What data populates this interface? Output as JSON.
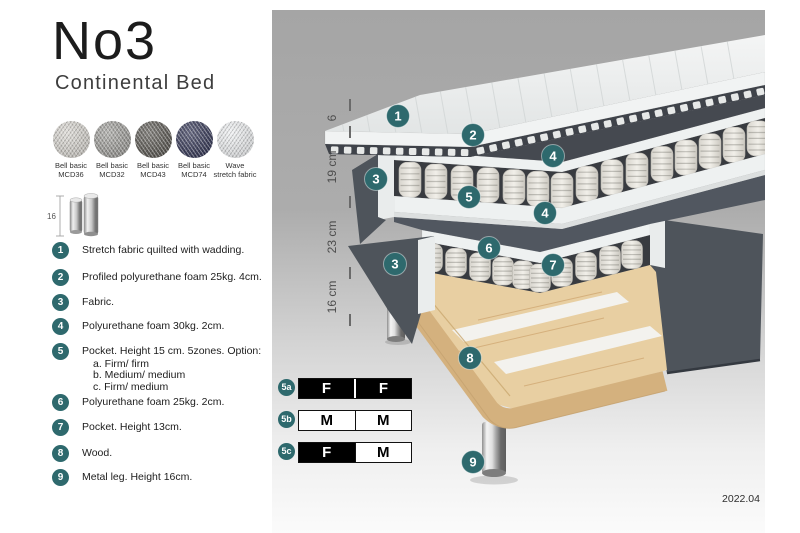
{
  "product": {
    "title": "No3",
    "subtitle": "Continental Bed",
    "version": "2022.04"
  },
  "colors": {
    "accent_teal": "#2e696d",
    "fabric_dark": "#4e545b",
    "wood": "#e8cfa2"
  },
  "swatches": [
    {
      "name": "Bell basic",
      "code": "MCD36",
      "color": "#d6d3cd"
    },
    {
      "name": "Bell basic",
      "code": "MCD32",
      "color": "#9c9b97"
    },
    {
      "name": "Bell basic",
      "code": "MCD43",
      "color": "#57544e"
    },
    {
      "name": "Bell basic",
      "code": "MCD74",
      "color": "#2f3253"
    },
    {
      "name": "Wave",
      "code": "stretch fabric",
      "color": "#edeff1"
    }
  ],
  "leg_spec": {
    "height_label": "16"
  },
  "legend": [
    {
      "num": "1",
      "text": "Stretch fabric quilted with wadding."
    },
    {
      "num": "2",
      "text": "Profiled polyurethane foam 25kg. 4cm."
    },
    {
      "num": "3",
      "text": "Fabric."
    },
    {
      "num": "4",
      "text": "Polyurethane foam 30kg. 2cm."
    },
    {
      "num": "5",
      "text": "Pocket. Height 15 cm. 5zones. Option:",
      "options": [
        "a. Firm/ firm",
        "b. Medium/ medium",
        "c. Firm/ medium"
      ]
    },
    {
      "num": "6",
      "text": "Polyurethane foam 25kg. 2cm."
    },
    {
      "num": "7",
      "text": "Pocket. Height 13cm."
    },
    {
      "num": "8",
      "text": "Wood."
    },
    {
      "num": "9",
      "text": "Metal leg. Height 16cm."
    }
  ],
  "diagram": {
    "measurements": [
      {
        "label": "6"
      },
      {
        "label": "19 cm"
      },
      {
        "label": "23 cm"
      },
      {
        "label": "16 cm"
      }
    ],
    "markers": [
      {
        "label": "1",
        "x": 126,
        "y": 106
      },
      {
        "label": "2",
        "x": 201,
        "y": 125
      },
      {
        "label": "4",
        "x": 281,
        "y": 146
      },
      {
        "label": "3",
        "x": 104,
        "y": 169
      },
      {
        "label": "5",
        "x": 197,
        "y": 187
      },
      {
        "label": "4",
        "x": 273,
        "y": 203
      },
      {
        "label": "6",
        "x": 217,
        "y": 238
      },
      {
        "label": "3",
        "x": 123,
        "y": 254
      },
      {
        "label": "7",
        "x": 281,
        "y": 255
      },
      {
        "label": "8",
        "x": 198,
        "y": 348
      },
      {
        "label": "9",
        "x": 201,
        "y": 452
      }
    ]
  },
  "firmness_table": {
    "rows": [
      {
        "id": "5a",
        "cells": [
          {
            "letter": "F",
            "variant": "dark"
          },
          {
            "letter": "F",
            "variant": "dark"
          }
        ]
      },
      {
        "id": "5b",
        "cells": [
          {
            "letter": "M",
            "variant": "light"
          },
          {
            "letter": "M",
            "variant": "light"
          }
        ]
      },
      {
        "id": "5c",
        "cells": [
          {
            "letter": "F",
            "variant": "dark"
          },
          {
            "letter": "M",
            "variant": "light"
          }
        ]
      }
    ]
  }
}
